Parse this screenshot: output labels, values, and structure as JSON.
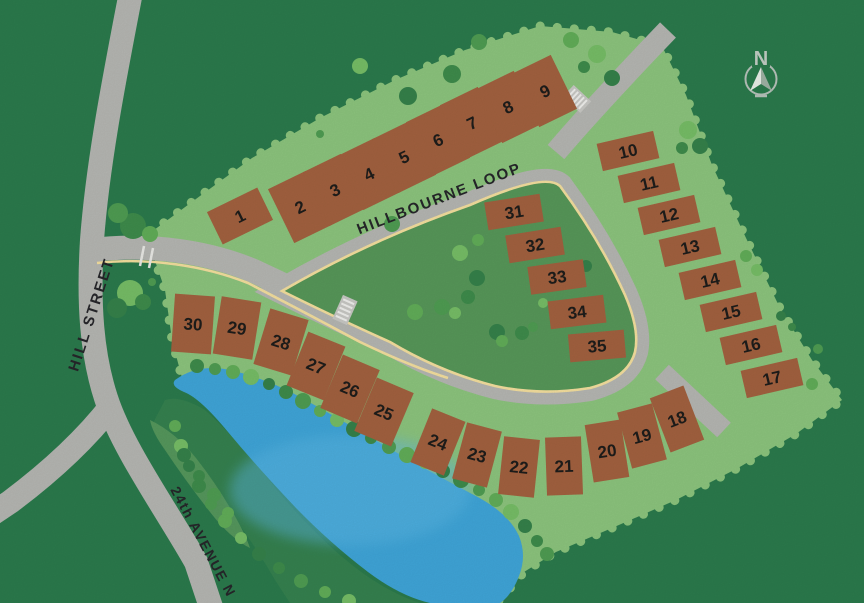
{
  "map": {
    "streets": {
      "hill_street": "HILL STREET",
      "hillbourne_loop": "HILLBOURNE LOOP",
      "avenue_24th": "24th AVENUE N"
    },
    "compass_letter": "N",
    "lots": [
      {
        "label": "1",
        "x": 240,
        "y": 216,
        "w": 56,
        "h": 36,
        "r": -26
      },
      {
        "label": "2",
        "x": 300,
        "y": 207,
        "w": 42,
        "h": 60,
        "r": -26
      },
      {
        "label": "3",
        "x": 335,
        "y": 190,
        "w": 42,
        "h": 60,
        "r": -26
      },
      {
        "label": "4",
        "x": 369,
        "y": 174,
        "w": 42,
        "h": 60,
        "r": -26
      },
      {
        "label": "5",
        "x": 404,
        "y": 157,
        "w": 42,
        "h": 60,
        "r": -26
      },
      {
        "label": "6",
        "x": 438,
        "y": 140,
        "w": 42,
        "h": 60,
        "r": -26
      },
      {
        "label": "7",
        "x": 472,
        "y": 123,
        "w": 42,
        "h": 60,
        "r": -26
      },
      {
        "label": "8",
        "x": 508,
        "y": 107,
        "w": 42,
        "h": 60,
        "r": -26
      },
      {
        "label": "9",
        "x": 545,
        "y": 91,
        "w": 42,
        "h": 60,
        "r": -26
      },
      {
        "label": "10",
        "x": 628,
        "y": 151,
        "w": 58,
        "h": 28,
        "r": -13
      },
      {
        "label": "11",
        "x": 649,
        "y": 183,
        "w": 58,
        "h": 28,
        "r": -13
      },
      {
        "label": "12",
        "x": 669,
        "y": 215,
        "w": 58,
        "h": 28,
        "r": -13
      },
      {
        "label": "13",
        "x": 690,
        "y": 247,
        "w": 58,
        "h": 28,
        "r": -13
      },
      {
        "label": "14",
        "x": 710,
        "y": 280,
        "w": 58,
        "h": 28,
        "r": -13
      },
      {
        "label": "15",
        "x": 731,
        "y": 312,
        "w": 58,
        "h": 28,
        "r": -13
      },
      {
        "label": "16",
        "x": 751,
        "y": 345,
        "w": 58,
        "h": 28,
        "r": -13
      },
      {
        "label": "17",
        "x": 772,
        "y": 378,
        "w": 58,
        "h": 28,
        "r": -13
      },
      {
        "label": "18",
        "x": 677,
        "y": 419,
        "w": 36,
        "h": 58,
        "r": -21
      },
      {
        "label": "19",
        "x": 642,
        "y": 436,
        "w": 36,
        "h": 58,
        "r": -15
      },
      {
        "label": "20",
        "x": 607,
        "y": 451,
        "w": 36,
        "h": 58,
        "r": -9
      },
      {
        "label": "21",
        "x": 564,
        "y": 466,
        "w": 36,
        "h": 58,
        "r": -2
      },
      {
        "label": "22",
        "x": 519,
        "y": 467,
        "w": 36,
        "h": 58,
        "r": 6
      },
      {
        "label": "23",
        "x": 477,
        "y": 455,
        "w": 36,
        "h": 58,
        "r": 15
      },
      {
        "label": "24",
        "x": 438,
        "y": 442,
        "w": 36,
        "h": 58,
        "r": 22
      },
      {
        "label": "25",
        "x": 384,
        "y": 412,
        "w": 40,
        "h": 58,
        "r": 23
      },
      {
        "label": "26",
        "x": 350,
        "y": 389,
        "w": 40,
        "h": 58,
        "r": 23
      },
      {
        "label": "27",
        "x": 316,
        "y": 366,
        "w": 40,
        "h": 58,
        "r": 22
      },
      {
        "label": "28",
        "x": 281,
        "y": 342,
        "w": 40,
        "h": 58,
        "r": 17
      },
      {
        "label": "29",
        "x": 237,
        "y": 328,
        "w": 40,
        "h": 58,
        "r": 9
      },
      {
        "label": "30",
        "x": 193,
        "y": 324,
        "w": 40,
        "h": 58,
        "r": 4
      },
      {
        "label": "31",
        "x": 514,
        "y": 212,
        "w": 56,
        "h": 28,
        "r": -9
      },
      {
        "label": "32",
        "x": 535,
        "y": 245,
        "w": 56,
        "h": 28,
        "r": -9
      },
      {
        "label": "33",
        "x": 557,
        "y": 277,
        "w": 56,
        "h": 28,
        "r": -8
      },
      {
        "label": "34",
        "x": 577,
        "y": 312,
        "w": 56,
        "h": 28,
        "r": -7
      },
      {
        "label": "35",
        "x": 597,
        "y": 346,
        "w": 56,
        "h": 28,
        "r": -5
      }
    ]
  },
  "colors": {
    "background_green": "#2b7a4c",
    "development_green": "#8cc47d",
    "island_green": "#579759",
    "road_gray": "#b5b6b2",
    "curb_yellow": "#f4df9e",
    "lot_brown": "#a2613f",
    "pond_blue": "#3fa5d8",
    "number_ink": "#1e1d1b",
    "compass_gray": "#b6c2ba"
  }
}
